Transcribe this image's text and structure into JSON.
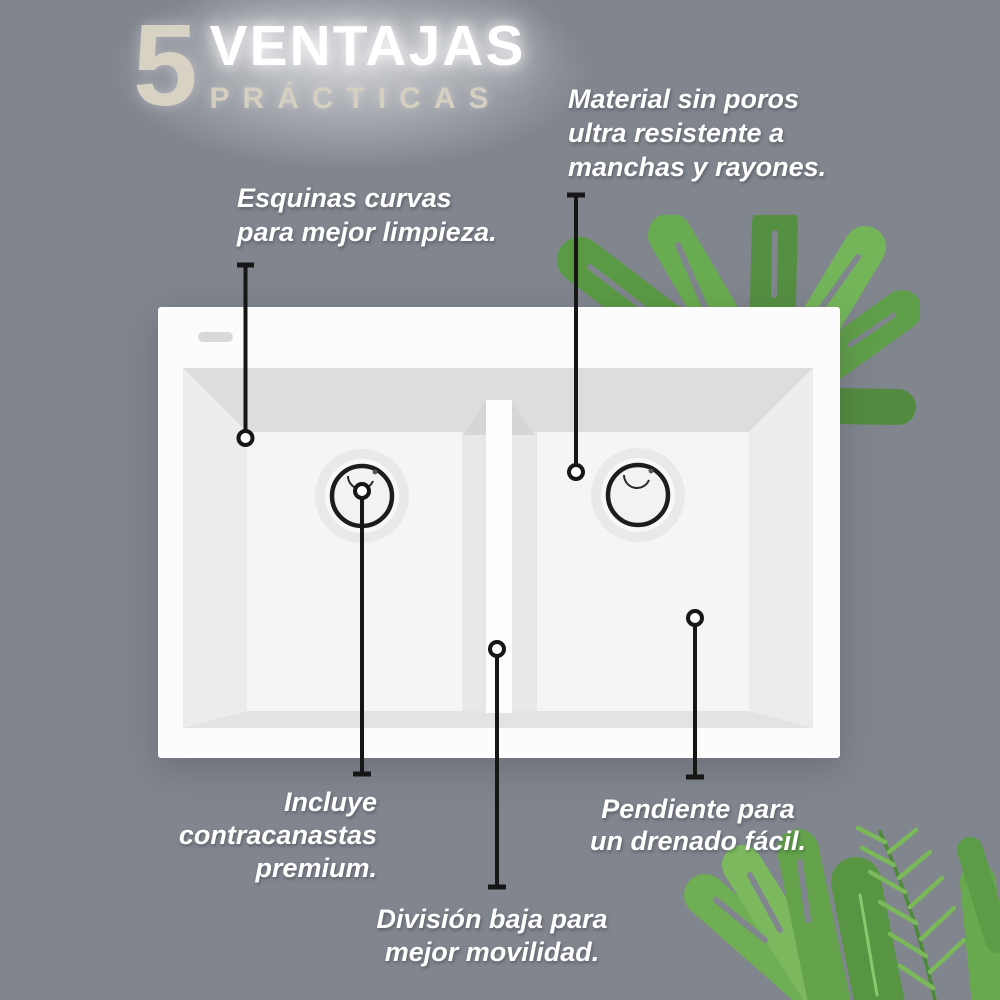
{
  "title": {
    "number": "5",
    "word_top": "VENTAJAS",
    "word_bottom": "PRÁCTICAS"
  },
  "callouts": {
    "corners": {
      "lines": [
        "Esquinas curvas",
        "para mejor limpieza."
      ]
    },
    "material": {
      "lines": [
        "Material sin poros",
        "ultra resistente a",
        "manchas y rayones."
      ]
    },
    "strainers": {
      "lines": [
        "Incluye",
        "contracanastas",
        "premium."
      ]
    },
    "divider": {
      "lines": [
        "División baja para",
        "mejor movilidad."
      ]
    },
    "drain": {
      "lines": [
        "Pendiente para",
        "un drenado fácil."
      ]
    }
  },
  "colors": {
    "background": "#81858e",
    "title_number": "#d8d2c5",
    "title_top": "#ffffff",
    "title_bottom": "#d5cfc2",
    "note_text": "#ffffff",
    "callout_line": "#161616",
    "sink_body": "#fcfcfc",
    "sink_basin": "#f4f4f4",
    "sink_shadow_wall": "#dddddd",
    "leaf_green_dark": "#4c8a3a",
    "leaf_green_mid": "#5f9f47",
    "leaf_green_light": "#7ab859"
  }
}
